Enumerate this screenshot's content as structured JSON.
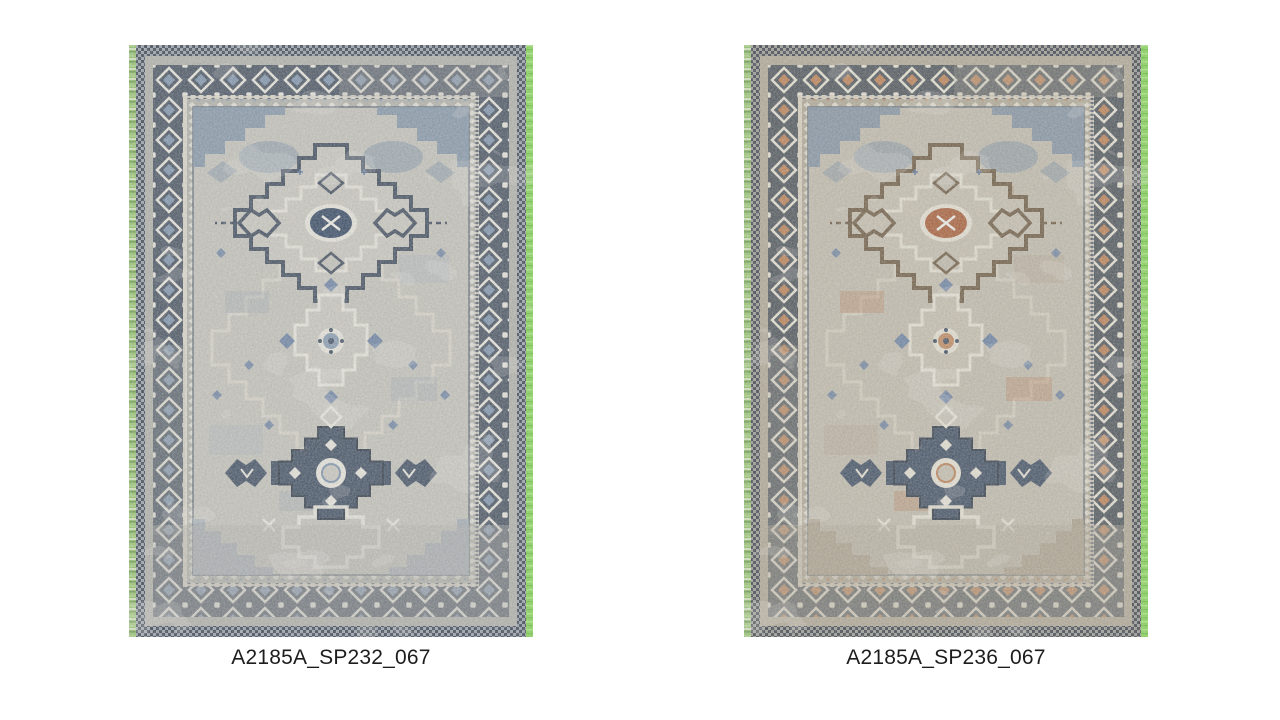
{
  "page": {
    "background": "#ffffff"
  },
  "rugs": [
    {
      "caption": "A2185A_SP232_067",
      "palette": {
        "green1": "#8cbf63",
        "green2": "#a7d080",
        "green3": "#6f9b52",
        "green4": "#d7e7bd",
        "lime": "#84d850",
        "lime2": "#a9e87e",
        "lime3": "#6cc23e",
        "edge": "#39414e",
        "edgelight": "#99a1ab",
        "band": "#b2b1aa",
        "borderbg": "#45505e",
        "motif": "#e9e6dc",
        "maccent": "#7e93ac",
        "guard": "#dcd7c9",
        "field": "#c5c3ba",
        "medfill": "#cbc8bf",
        "outline": "#3e4a5a",
        "center": "#324560",
        "dkmed": "#3f4d60",
        "spandrel": "#7e92a6",
        "spandrel2": "#9fa9b3",
        "patch": "#aab3bc",
        "warmbit": "#97a3b0",
        "accsm": "#5a759d",
        "latline": "#d9d6ca"
      }
    },
    {
      "caption": "A2185A_SP236_067",
      "palette": {
        "green1": "#8cbf63",
        "green2": "#a7d080",
        "green3": "#6f9b52",
        "green4": "#d7e7bd",
        "lime": "#84d850",
        "lime2": "#a9e87e",
        "lime3": "#6cc23e",
        "edge": "#3b4048",
        "edgelight": "#9c9a93",
        "band": "#b1a894",
        "borderbg": "#4b5156",
        "motif": "#e7e1d2",
        "maccent": "#bd7f51",
        "guard": "#d9d0bd",
        "field": "#c2bbab",
        "medfill": "#c7bfae",
        "outline": "#6e5a40",
        "center": "#a95c34",
        "dkmed": "#3f4d60",
        "spandrel": "#7e8fa0",
        "spandrel2": "#a89a82",
        "patch": "#b3a189",
        "warmbit": "#b5713f",
        "accsm": "#5a759d",
        "latline": "#d6cfbe"
      }
    }
  ]
}
